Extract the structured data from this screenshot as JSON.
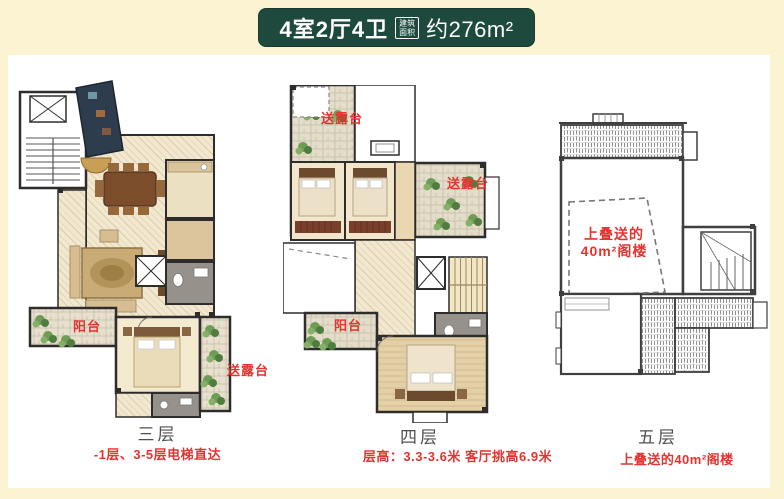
{
  "header": {
    "title": "4室2厅4卫",
    "area_badge": {
      "line1": "建筑",
      "line2": "面积"
    },
    "area_value": "约276m²"
  },
  "floors": [
    {
      "name": "三层",
      "note": "-1层、3-5层电梯直达"
    },
    {
      "name": "四层",
      "note": "层高：3.3-3.6米 客厅挑高6.9米"
    },
    {
      "name": "五层",
      "note": "上叠送的40m²阁楼"
    }
  ],
  "plan_labels": {
    "f3": {
      "balcony": "阳台",
      "terrace": "送露台"
    },
    "f4": {
      "terrace_top": "送露台",
      "terrace_right": "送露台",
      "balcony": "阳台"
    },
    "f5": {
      "attic_line1": "上叠送的",
      "attic_line2": "40m²阁楼"
    }
  },
  "colors": {
    "page_bg": "#fbf3d1",
    "header_bg": "#1d4a3d",
    "accent_red": "#e23430",
    "floor_label": "#4f4f4f"
  }
}
